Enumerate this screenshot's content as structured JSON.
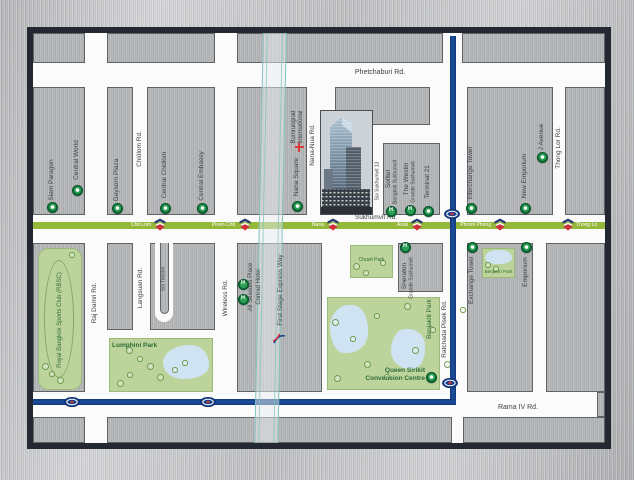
{
  "colors": {
    "bts_green": "#93b83a",
    "mrt_blue": "#1d4f9e",
    "park_green": "#bcd49c",
    "lake_blue": "#cfe3f2",
    "marker_green": "#0b6b33",
    "hospital_red": "#dd3a3a",
    "expressway_teal": "#8fccc4",
    "frame_dark": "#242832"
  },
  "icons": {
    "hotel_glyph": "H"
  },
  "roads": {
    "phetchaburi": "Phetchaburi Rd.",
    "sukhumvit": "Sukhumvit Rd.",
    "rama_iv": "Rama IV Rd.",
    "chidlom": "Chidlom Rd.",
    "nana_nua": "Nana-Nua Rd.",
    "soi_sukhumvit_13": "Soi Sukhumvit 13",
    "thong_lor": "Thong Lor Rd.",
    "raj_damri": "Raj Damri Rd.",
    "langsuan": "Langsuan Rd.",
    "soi_tonson": "Soi Tonson",
    "wireless": "Wireless Rd.",
    "ratchada_pisek": "Ratchada Pisek Rd.",
    "expressway": "First Stage Express Way"
  },
  "transit": {
    "bts_stations": [
      "Chit Lom",
      "Ploen Chit",
      "Nana",
      "Asok",
      "Phrom Phong",
      "Thong Lo"
    ]
  },
  "places": {
    "siam_paragon": "Siam Paragon",
    "central_world": "Central World",
    "gaysorn_plaza": "Gaysorn Plaza",
    "central_chidlom": "Central Chidlom",
    "central_embassy": "Central Embassy",
    "nana_square": "Nana Square",
    "bumrungrad_line1": "Bumrungrad",
    "bumrungrad_line2": "International",
    "sofitel_line1": "Sofitel",
    "sofitel_line2": "Bangkok Sukhumvit",
    "westin_line1": "The Westin",
    "westin_line2": "Grande Sukhumvit",
    "terminal_21": "Terminal 21",
    "interchange_tower": "Interchange Tower",
    "new_emporium": "New Emporium",
    "j_avenue": "J Avenue",
    "all_seasons_line1": "All Seasons Place",
    "all_seasons_line2": "Conrad Hotel",
    "sheraton_line1": "Sheraton",
    "sheraton_line2": "Grande Sukhumvit",
    "exchange_tower": "Exchange Tower",
    "emporium": "Emporium",
    "qsncc_line1": "Queen Sirikit",
    "qsncc_line2": "Convension Centre"
  },
  "parks": {
    "rbsc": "Royal Bangkok Sports Club (RBSC)",
    "lumphini": "Lumphini Park",
    "chuvit": "Chuvit Park",
    "benjakiti": "Benjakiti Park",
    "benjasiri": "Benjasiri Park"
  }
}
